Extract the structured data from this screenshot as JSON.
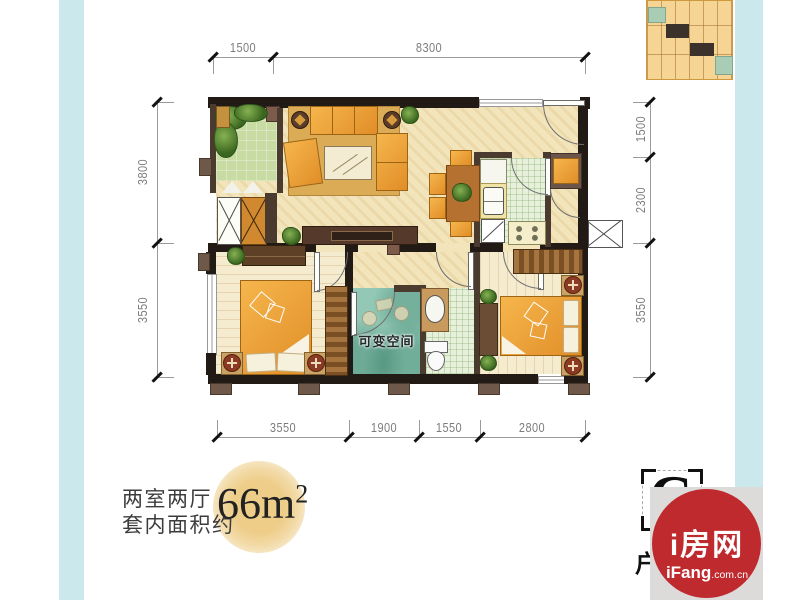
{
  "dims": {
    "top": [
      "1500",
      "8300"
    ],
    "left": [
      "3800",
      "3550"
    ],
    "right": [
      "1500",
      "2300",
      "3550"
    ],
    "bottom": [
      "3550",
      "1900",
      "1550",
      "2800"
    ]
  },
  "plan": {
    "flex_room_label": "可变空间"
  },
  "title_block": {
    "layout": "两室两厅",
    "area_prefix": "套内面积约",
    "area_value": "66m",
    "area_sup": "2"
  },
  "unit_badge": {
    "letter": "C",
    "partial_char": "户"
  },
  "logo": {
    "cn": "i房网",
    "en_bold": "iFang",
    "en_suffix": ".com.cn"
  },
  "colors": {
    "accent_bar": "#cbe9ec",
    "logo_red": "#bf2a2e",
    "wall_black": "#221a14",
    "wall_brown": "#4b3a2e",
    "floor_beige": "#f2e4bb",
    "garden_green": "#c7dba3",
    "flex_teal": "#92c8b5",
    "furniture_orange": "#f0a93f",
    "gold_circle": "#eecd89",
    "minimap_tan": "#f6d494"
  }
}
